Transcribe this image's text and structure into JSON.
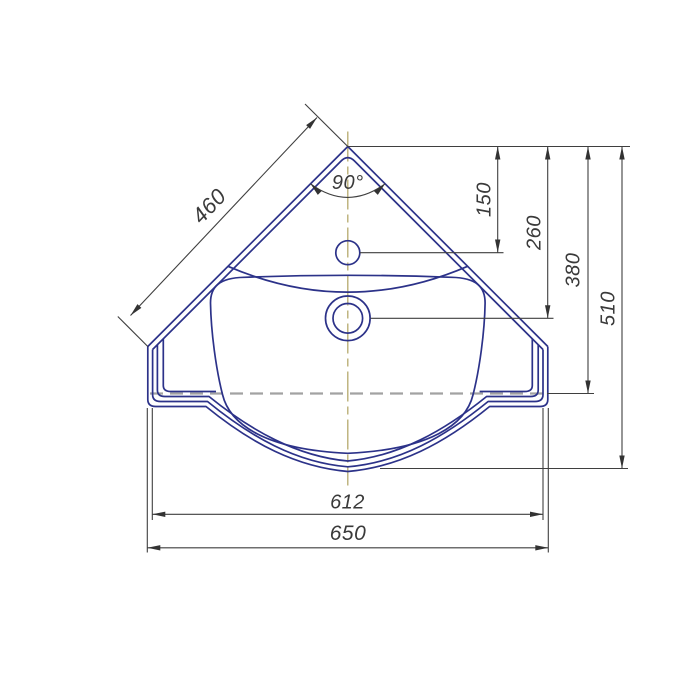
{
  "drawing": {
    "title": "corner-washbasin-plan-view-technical-drawing",
    "labels": {
      "diagonal_width": "460",
      "corner_angle": "90°",
      "offset_faucet": "150",
      "offset_drain": "260",
      "offset_front_edge": "380",
      "depth_total": "510",
      "width_inner": "612",
      "width_total": "650"
    },
    "colors": {
      "outline": "#2c3289",
      "dimension": "#3f3f3f",
      "centerline_vertical": "#b5aa6d",
      "centerline_dashed": "#a2a2a2",
      "background": "#ffffff"
    }
  }
}
